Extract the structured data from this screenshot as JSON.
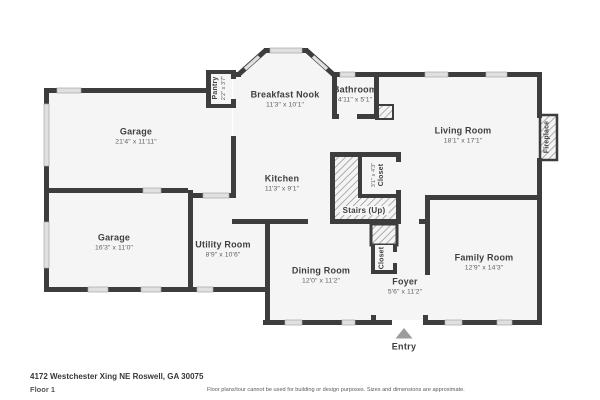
{
  "plan": {
    "rooms": [
      {
        "name": "Garage",
        "dims": "21'4\" x 11'11\""
      },
      {
        "name": "Garage",
        "dims": "16'3\" x 11'0\""
      },
      {
        "name": "Utility Room",
        "dims": "8'9\" x 10'6\""
      },
      {
        "name": "Breakfast Nook",
        "dims": "11'3\" x 10'1\""
      },
      {
        "name": "Kitchen",
        "dims": "11'3\" x 9'1\""
      },
      {
        "name": "Bathroom",
        "dims": "4'11\" x 5'1\""
      },
      {
        "name": "Living Room",
        "dims": "18'1\" x 17'1\""
      },
      {
        "name": "Dining Room",
        "dims": "12'0\" x 11'2\""
      },
      {
        "name": "Foyer",
        "dims": "5'6\" x 11'2\""
      },
      {
        "name": "Family Room",
        "dims": "12'9\" x 14'3\""
      }
    ],
    "features": {
      "pantry": {
        "name": "Pantry",
        "dims": "2'2\" x 3'7\""
      },
      "closet_stairs": {
        "name": "Closet",
        "dims": "3'1\" x 4'3\""
      },
      "closet_foyer": {
        "name": "Closet"
      },
      "stairs": {
        "name": "Stairs (Up)"
      },
      "fireplace": {
        "name": "Fireplace"
      },
      "entry": {
        "name": "Entry"
      }
    },
    "colors": {
      "wall": "#3d3d3d",
      "room_fill": "#f5f5f5",
      "window_fill": "#e0e0e0",
      "entry_arrow": "#9c9c9c"
    }
  },
  "footer": {
    "address": "4172 Westchester Xing NE Roswell, GA 30075",
    "floor": "Floor 1",
    "disclaimer": "Floor plans/tour cannot be used for building or design purposes. Sizes and dimensions are approximate."
  }
}
